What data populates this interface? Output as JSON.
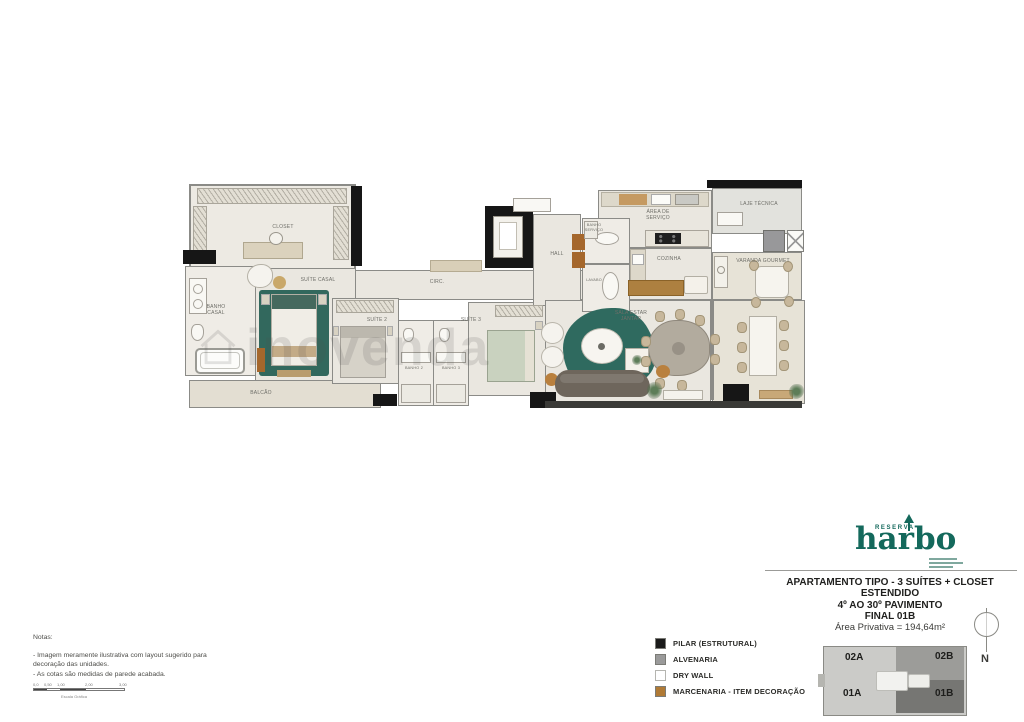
{
  "watermark": "inovenda",
  "plan": {
    "labels": {
      "closet": "CLOSET",
      "suite_casal": "SUÍTE CASAL",
      "banho_casal": "BANHO CASAL",
      "balcao": "BALCÃO",
      "suite2": "SUÍTE 2",
      "suite3": "SUÍTE 3",
      "banho2": "BANHO 2",
      "banho3": "BANHO 3",
      "circ": "CIRC.",
      "hall": "HALL",
      "banho_servico": "BANHO SERVIÇO",
      "lavabo": "LAVABO",
      "area_servico": "ÁREA DE SERVIÇO",
      "cozinha": "COZINHA",
      "laje_tecnica": "LAJE TÉCNICA",
      "varanda_gourmet": "VARANDA GOURMET",
      "sala": "SALA ESTAR JANTAR"
    }
  },
  "brand": {
    "reserva": "RESERVA",
    "name": "harbo",
    "color": "#14695c"
  },
  "title_block": {
    "line1": "APARTAMENTO TIPO - 3 SUÍTES + CLOSET",
    "line2": "ESTENDIDO",
    "line3": "4º AO 30º PAVIMENTO",
    "line4": "FINAL 01B",
    "area": "Área Privativa = 194,64m²"
  },
  "legend": {
    "items": [
      {
        "label": "PILAR (ESTRUTURAL)",
        "color": "#1a1a1a"
      },
      {
        "label": "ALVENARIA",
        "color": "#9a9a9a"
      },
      {
        "label": "DRY WALL",
        "color": "#ffffff"
      },
      {
        "label": "MARCENARIA - ITEM DECORAÇÃO",
        "color": "#b07a35"
      }
    ]
  },
  "notes": {
    "title": "Notas:",
    "line1": "- Imagem meramente ilustrativa com layout sugerido para",
    "line2": "decoração das unidades.",
    "line3": "- As cotas são medidas de parede acabada.",
    "scale_ticks": [
      "0,0",
      "0,50",
      "1,00",
      "2,00",
      "3,00"
    ],
    "scale_caption": "Escala Gráfica"
  },
  "keyplan": {
    "units": {
      "a2": "02A",
      "b2": "02B",
      "a1": "01A",
      "b1": "01B"
    },
    "north": "N"
  },
  "colors": {
    "accent_green": "#14695c",
    "rug_teal": "#2f6a5f",
    "marcenaria": "#b07a35",
    "floor": "#eae7e0",
    "wall": "#8b8b87",
    "pillar": "#161616"
  }
}
